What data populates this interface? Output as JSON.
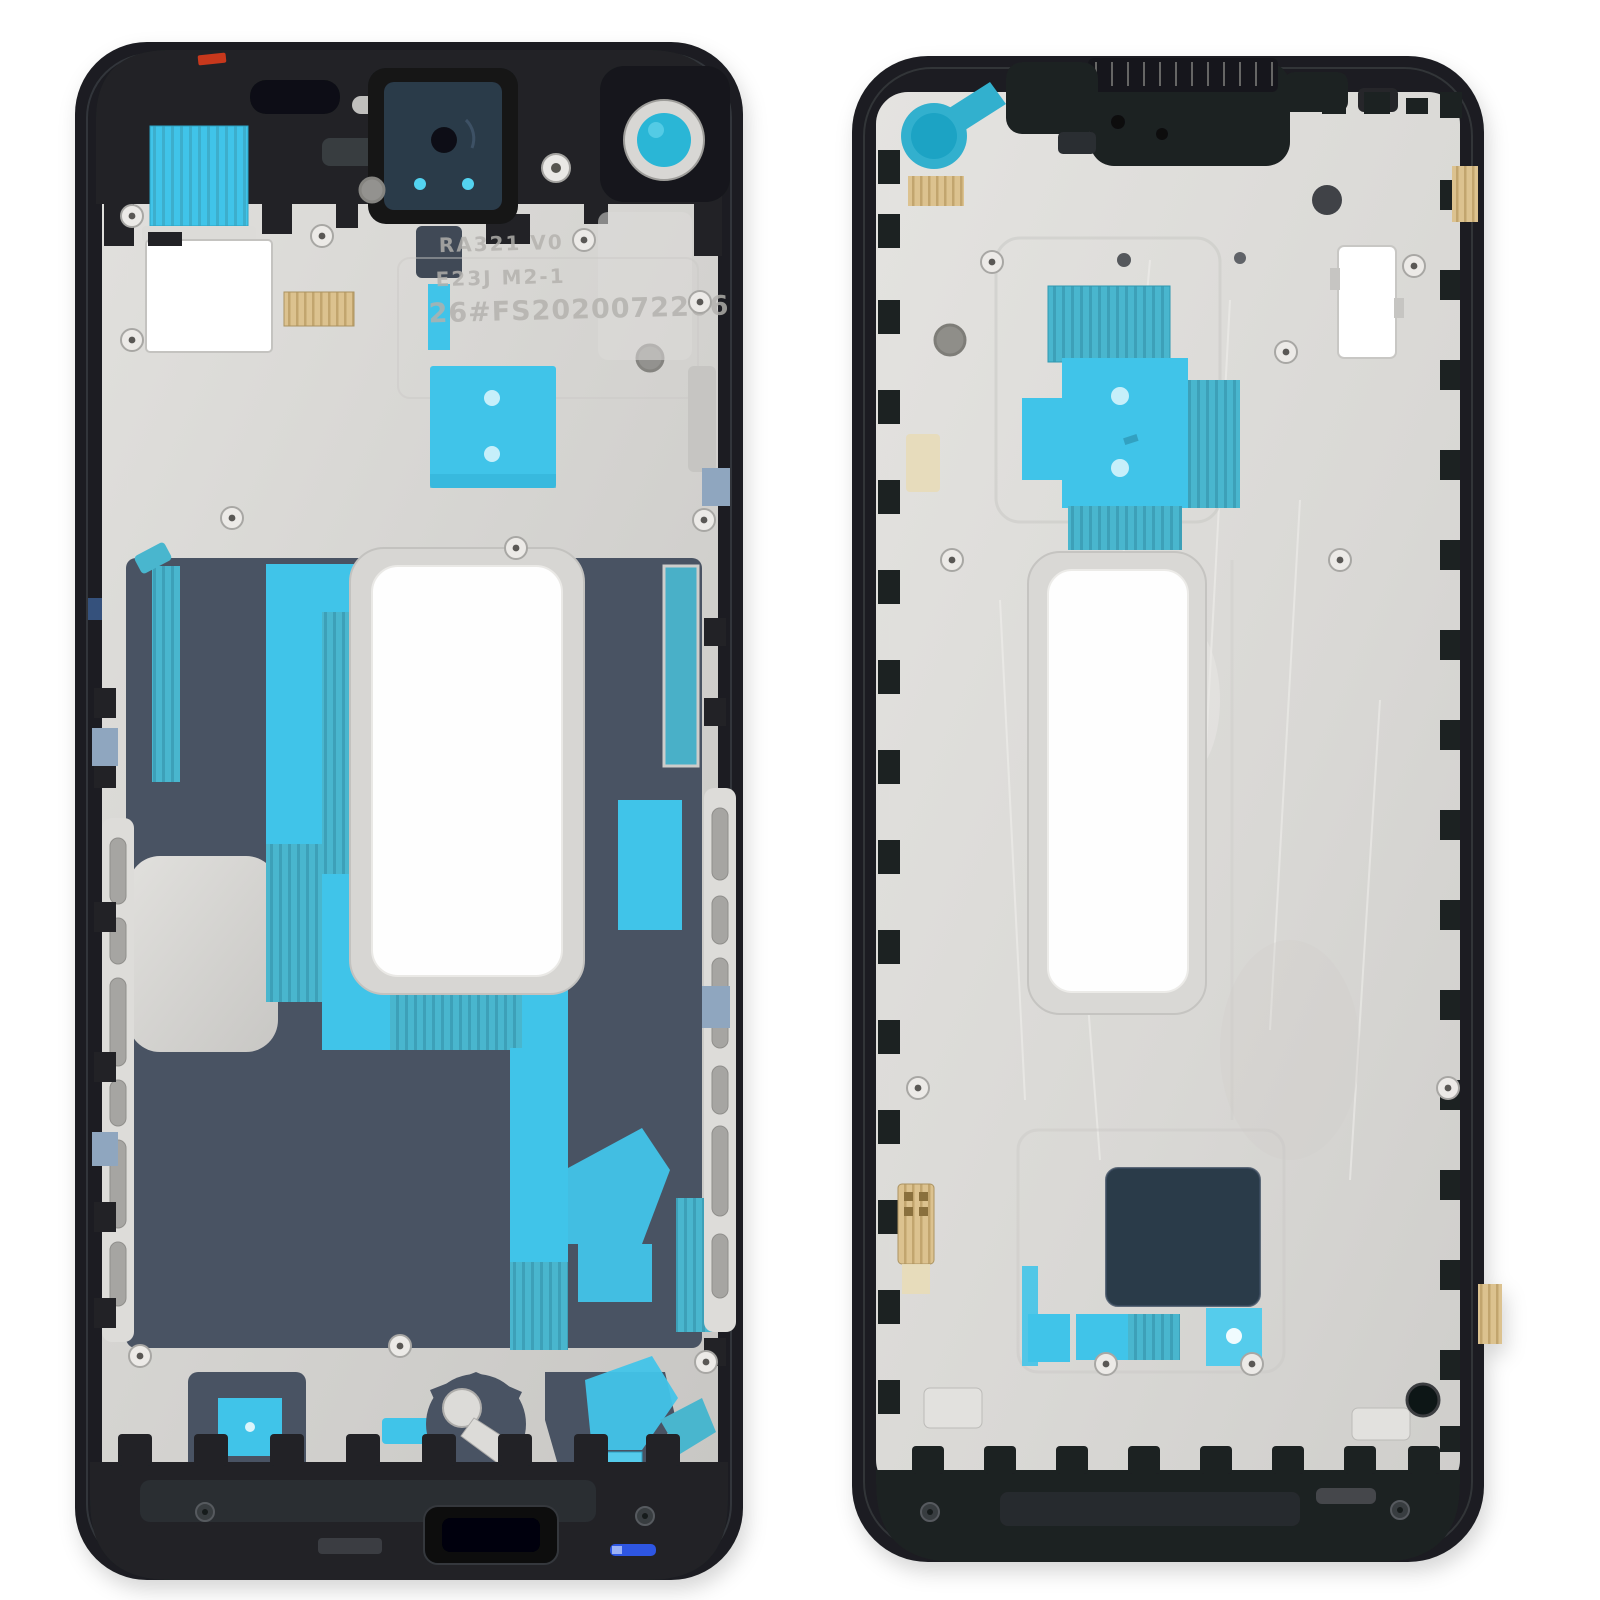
{
  "photo": {
    "subject": "Product photo: two smartphone middle-frame bezel plates (front and back views) on a white background",
    "left_plate": {
      "engraving_line1": "RA321 V0",
      "engraving_line2": "E23J M2-1",
      "engraving_serial": "26#FS2020072206"
    },
    "right_plate": {},
    "palette": {
      "background": "#ffffff",
      "frame": "#1b1d20",
      "plastic": "#222427",
      "silver": "#d5d4d1",
      "silver_light": "#e3e2df",
      "silver_dark": "#bfbebb",
      "slate": "#4a5363",
      "navy": "#2b3a4a",
      "cyan": "#41c4e9",
      "teal": "#49b6ce",
      "teal_dark": "#3a9db4",
      "teal_circle": "#29b6d6",
      "steel": "#8fa6bf",
      "tan": "#dcc28f",
      "red": "#c8391f",
      "blue": "#2e56e2",
      "engrave": "#b3b1ad",
      "hole": "#8e8d8a"
    }
  }
}
